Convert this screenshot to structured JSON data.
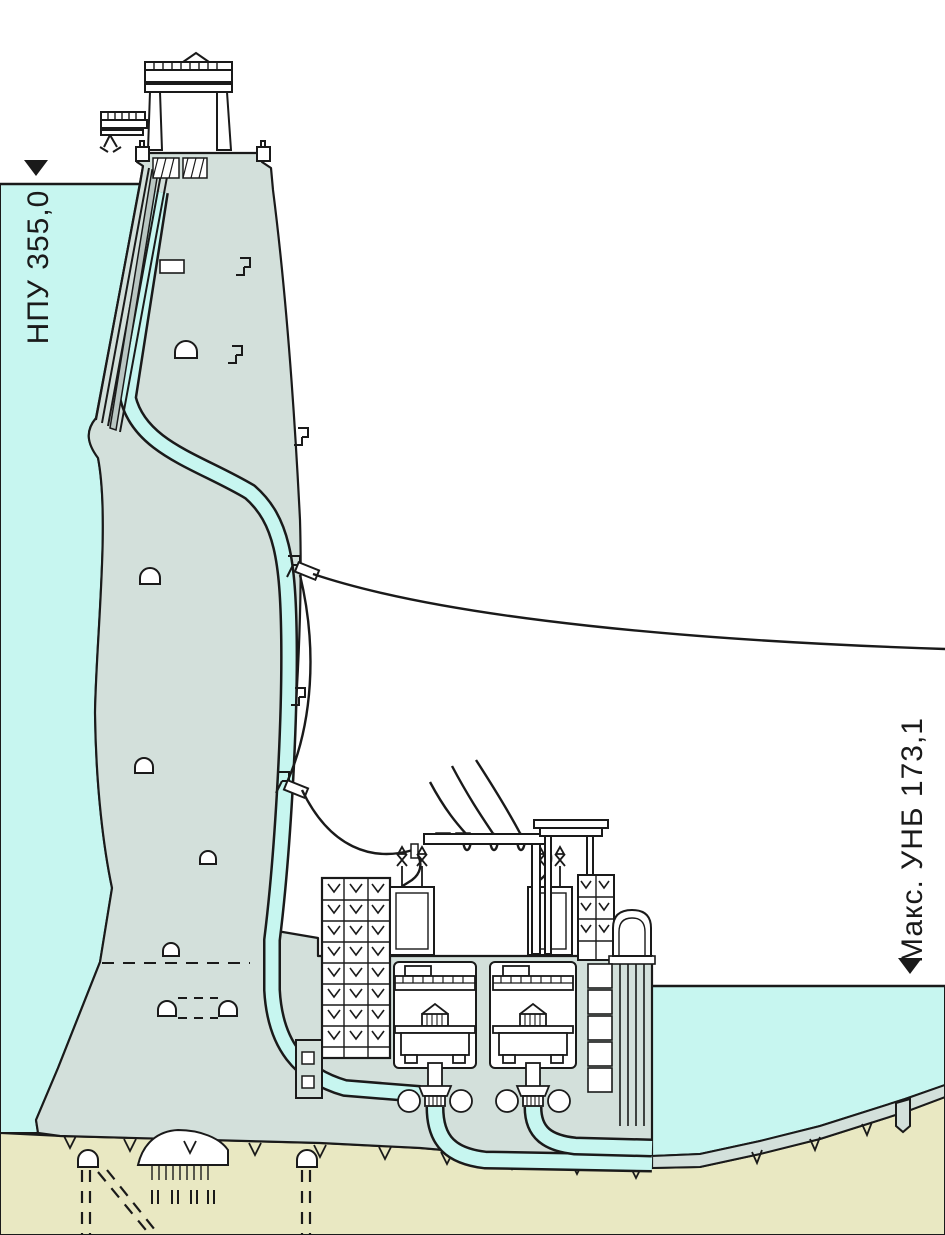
{
  "diagram": {
    "kind": "dam-cross-section",
    "labels": {
      "headwater_level": "НПУ 355,0",
      "tailwater_level": "Макс. УНБ 173,1"
    },
    "icons": {
      "headwater_marker": "level-marker-triangle",
      "tailwater_marker": "level-marker-triangle"
    },
    "colors": {
      "water": "#c7f6f0",
      "concrete": "#d3e0db",
      "ground": "#e9e8c2",
      "line": "#1a1a1a",
      "gate": "#b9c6c2",
      "background": "#ffffff"
    }
  }
}
